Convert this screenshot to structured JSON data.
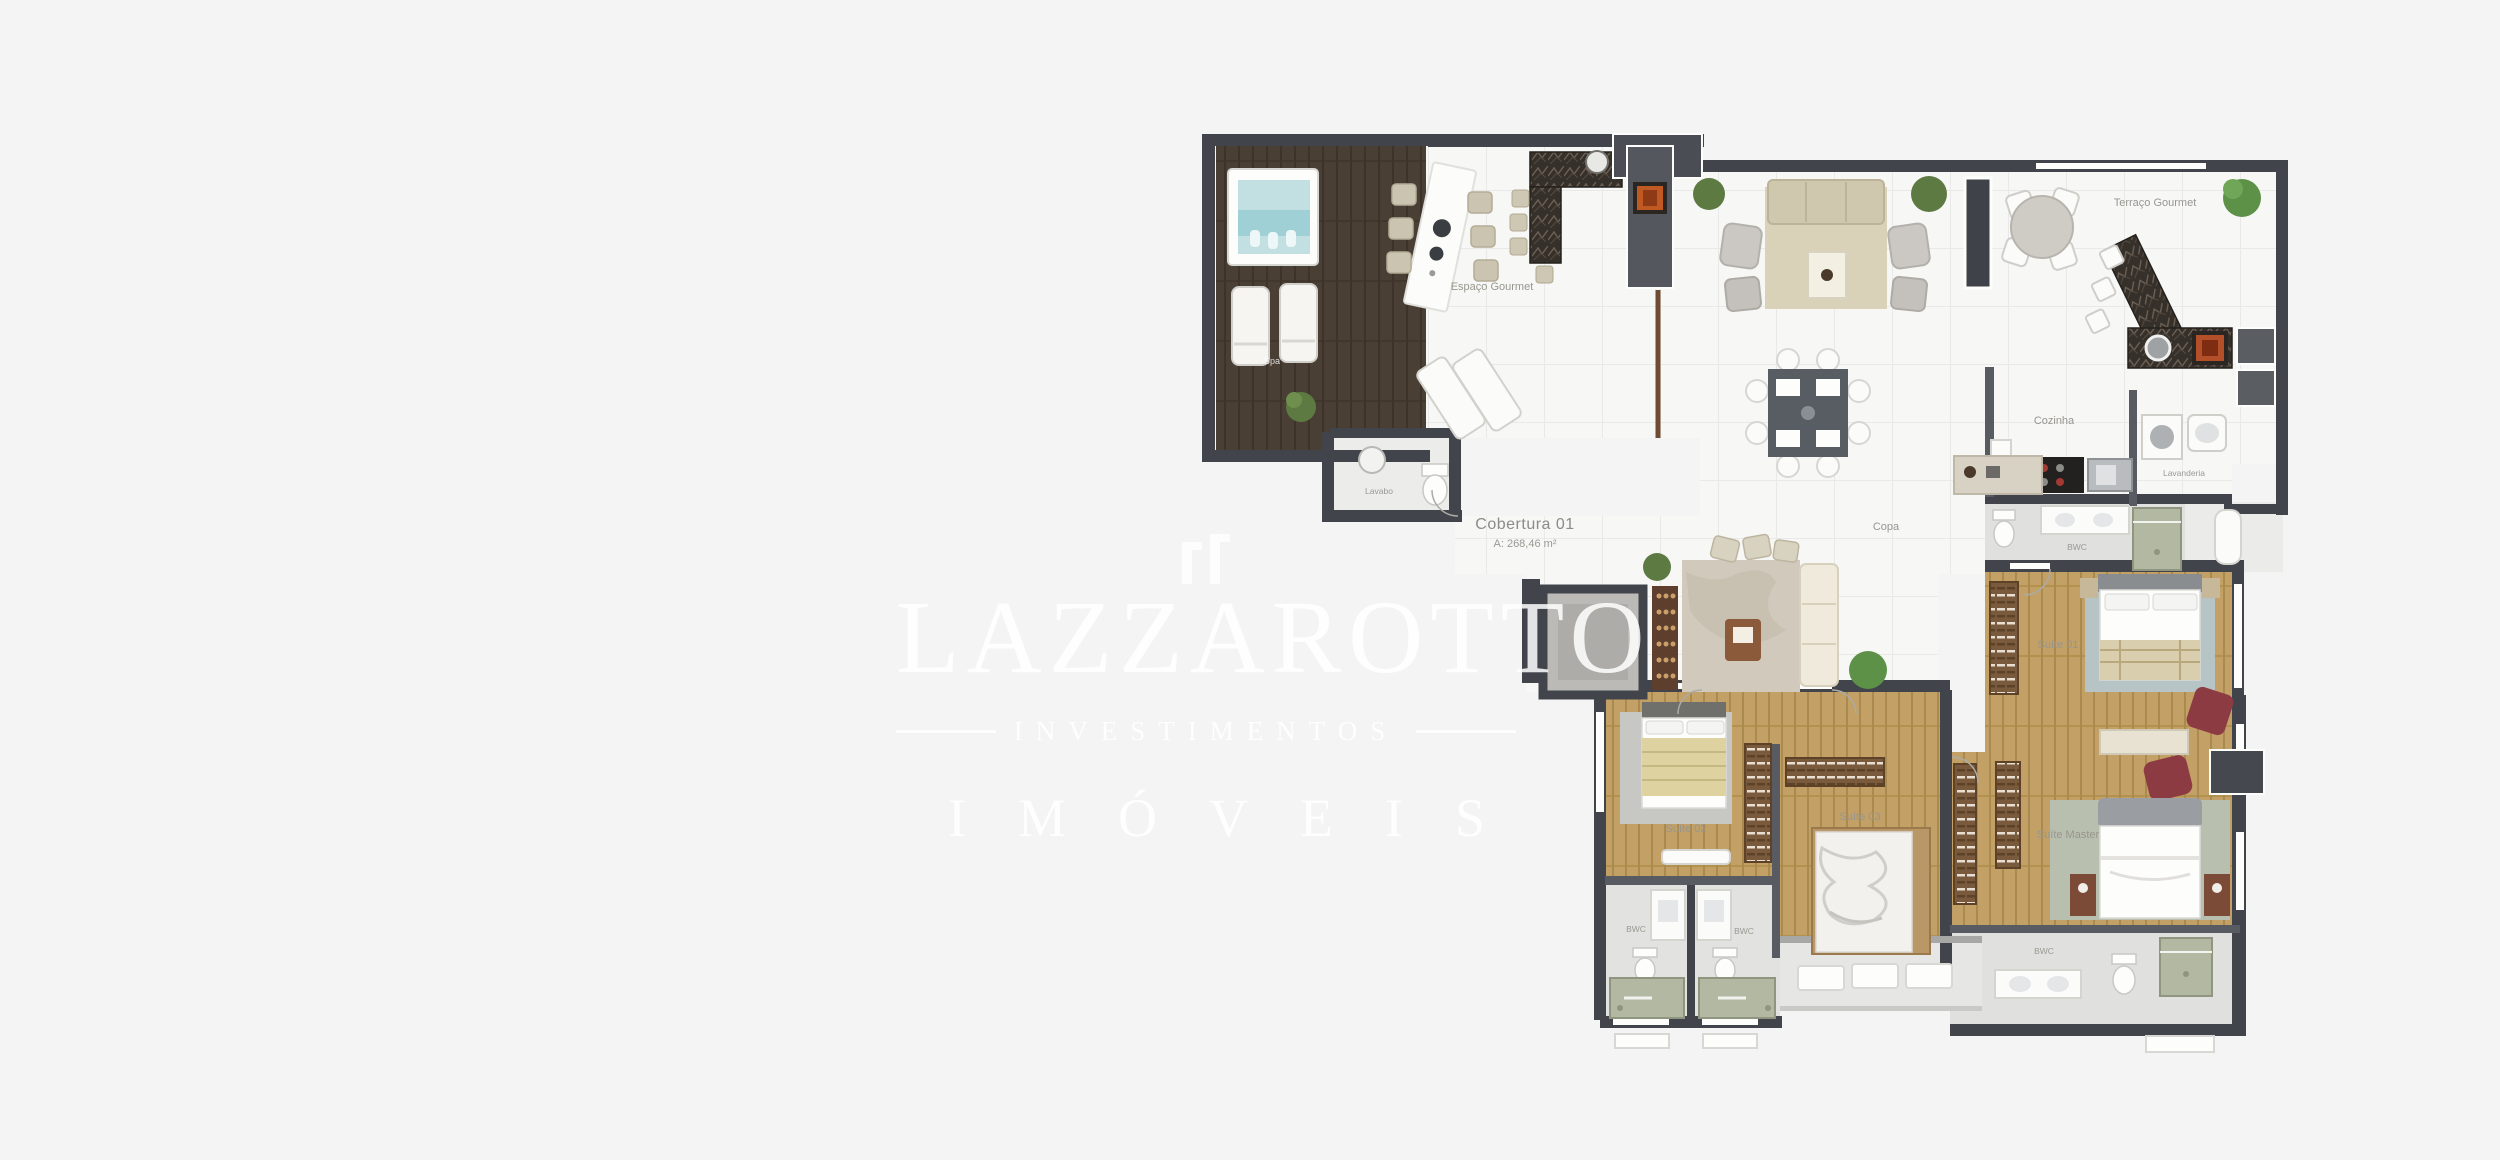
{
  "plan": {
    "title": "Cobertura 01",
    "area": "A: 268,46 m²"
  },
  "labels": {
    "spa": "Spa",
    "espaco_gourmet": "Espaço Gourmet",
    "terraco_gourmet": "Terraço Gourmet",
    "cozinha": "Cozinha",
    "lavanderia": "Lavanderia",
    "copa": "Copa",
    "lavabo": "Lavabo",
    "bwc_suite01": "BWC",
    "suite01": "Suíte 01",
    "suite02": "Suíte 02",
    "suite03": "Suíte 03",
    "suite_master": "Suíte Master",
    "bwc_master": "BWC",
    "bwc01": "BWC",
    "bwc02": "BWC"
  },
  "watermark": {
    "name": "LAZZAROTTO",
    "subtitle": "INVESTIMENTOS",
    "category": "IMÓVEIS"
  },
  "colors": {
    "background": "#f4f4f5",
    "wall": "#41444b",
    "tile": "#f7f7f6",
    "deck_wood": "#4a3f35",
    "bedroom_wood": "#c2a066",
    "wet_floor": "#e0e0de",
    "shower_green": "#b2b8a2",
    "spa_water": "#c2dfe2",
    "accent_chair_red": "#8d3b43",
    "fire_orange": "#c05a22"
  }
}
